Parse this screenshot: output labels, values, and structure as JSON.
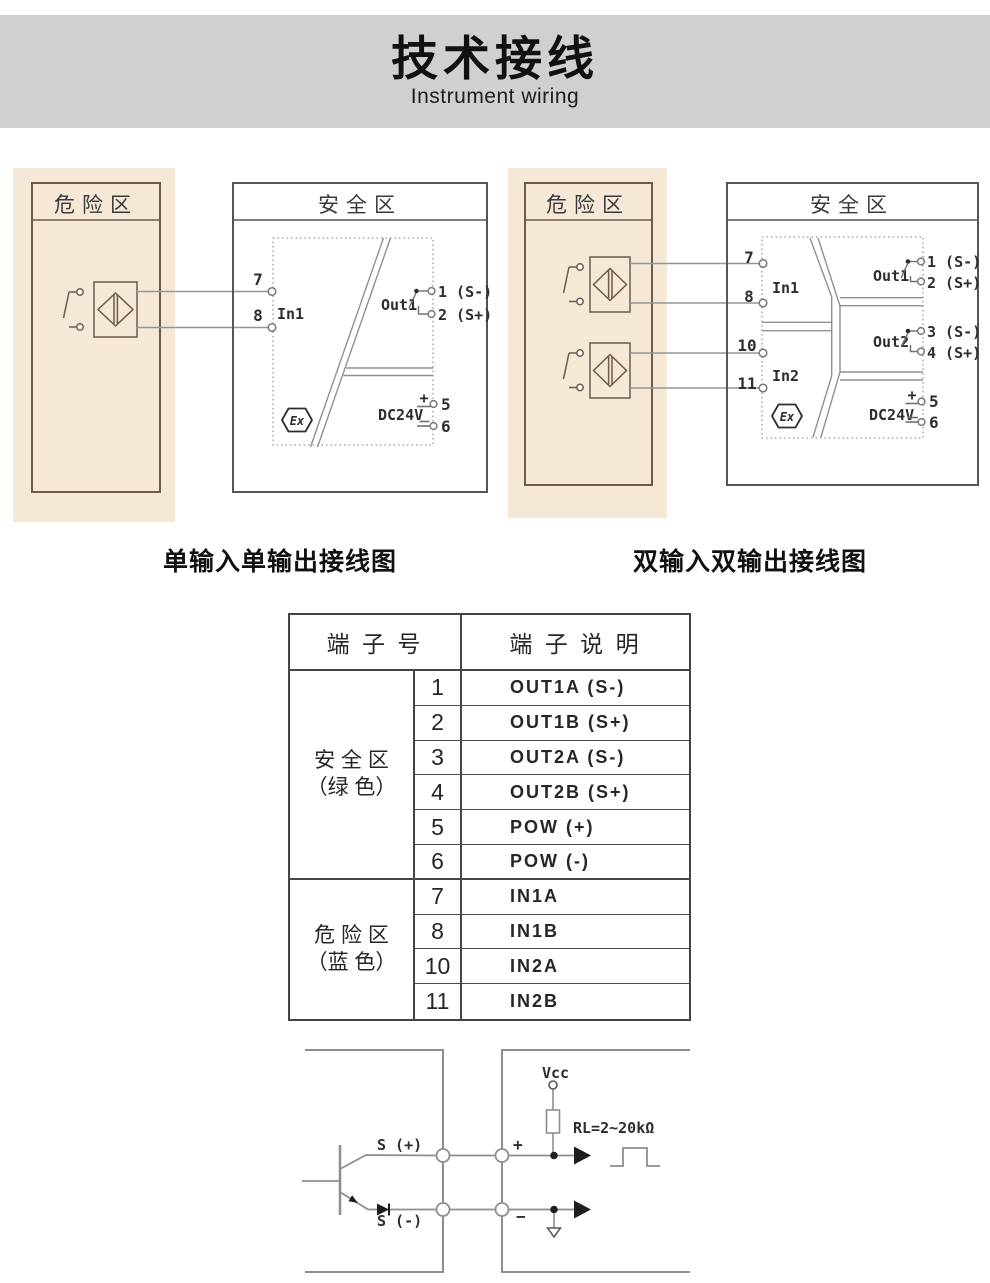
{
  "header": {
    "title": "技术接线",
    "subtitle": "Instrument wiring"
  },
  "diagrams": {
    "single": {
      "caption": "单输入单输出接线图",
      "hazard_label": "危险区",
      "safe_label": "安全区",
      "ex_mark": "Ex",
      "t7": "7",
      "t8": "8",
      "in1": "In1",
      "out1": "Out1",
      "out1_a": "1 (S-)",
      "out1_b": "2 (S+)",
      "dc": "DC24V",
      "plus": "+",
      "t5": "5",
      "t6": "6"
    },
    "dual": {
      "caption": "双输入双输出接线图",
      "hazard_label": "危险区",
      "safe_label": "安全区",
      "ex_mark": "Ex",
      "t7": "7",
      "t8": "8",
      "t10": "10",
      "t11": "11",
      "in1": "In1",
      "in2": "In2",
      "out1": "Out1",
      "out1_a": "1 (S-)",
      "out1_b": "2 (S+)",
      "out2": "Out2",
      "out2_a": "3 (S-)",
      "out2_b": "4 (S+)",
      "dc": "DC24V",
      "plus": "+",
      "t5": "5",
      "t6": "6"
    }
  },
  "table": {
    "col_terminal": "端 子 号",
    "col_desc": "端 子 说 明",
    "groups": [
      {
        "zone_line1": "安 全 区",
        "zone_line2": "（绿 色）",
        "rows": [
          {
            "no": "1",
            "desc": "OUT1A (S-)"
          },
          {
            "no": "2",
            "desc": "OUT1B (S+)"
          },
          {
            "no": "3",
            "desc": "OUT2A (S-)"
          },
          {
            "no": "4",
            "desc": "OUT2B (S+)"
          },
          {
            "no": "5",
            "desc": "POW (+)"
          },
          {
            "no": "6",
            "desc": "POW (-)"
          }
        ]
      },
      {
        "zone_line1": "危 险 区",
        "zone_line2": "（蓝 色）",
        "rows": [
          {
            "no": "7",
            "desc": "IN1A"
          },
          {
            "no": "8",
            "desc": "IN1B"
          },
          {
            "no": "10",
            "desc": "IN2A"
          },
          {
            "no": "11",
            "desc": "IN2B"
          }
        ]
      }
    ]
  },
  "schematic": {
    "s_plus": "S (+)",
    "s_minus": "S (-)",
    "vcc": "Vcc",
    "rl": "RL=2~20kΩ",
    "plus": "+",
    "minus": "−"
  }
}
